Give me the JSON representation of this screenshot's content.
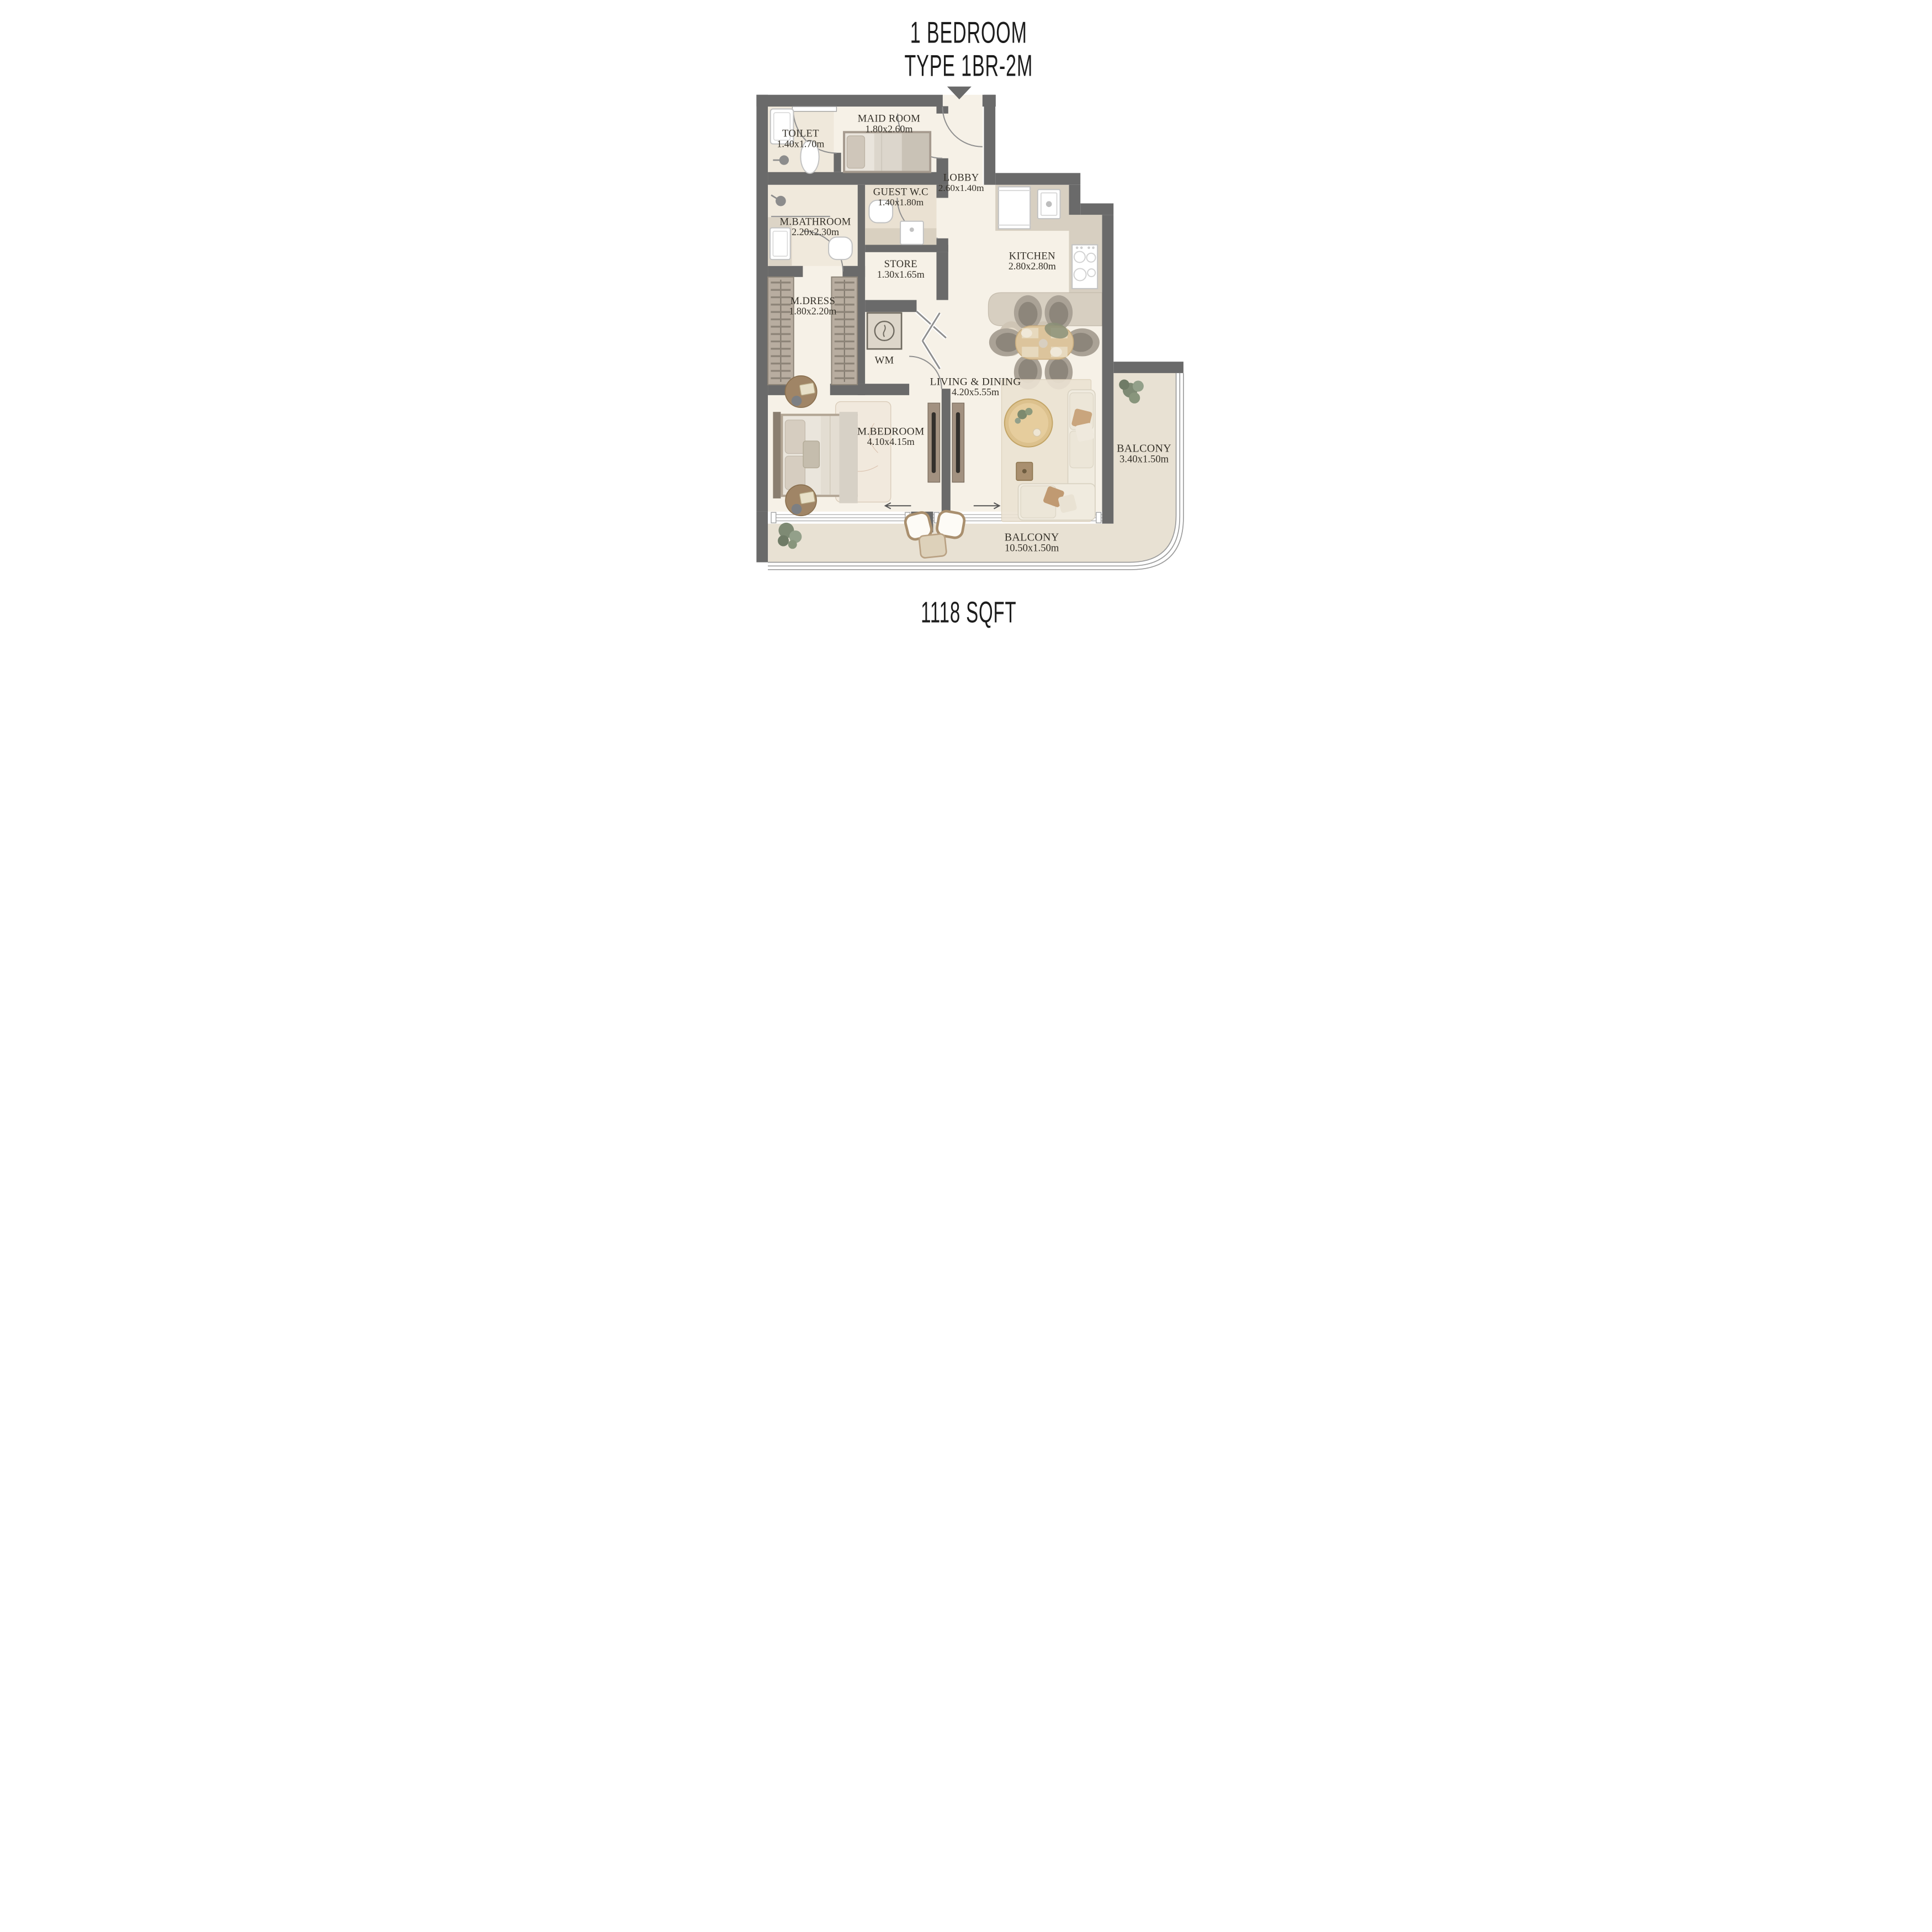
{
  "title": {
    "line1": "1 BEDROOM",
    "line2": "TYPE 1BR-2M"
  },
  "area_label": "1118 SQFT",
  "rooms": {
    "toilet": {
      "name": "TOILET",
      "dims": "1.40x1.70m"
    },
    "maid_room": {
      "name": "MAID ROOM",
      "dims": "1.80x2.60m"
    },
    "guest_wc": {
      "name": "GUEST W.C",
      "dims": "1.40x1.80m"
    },
    "lobby": {
      "name": "LOBBY",
      "dims": "2.60x1.40m"
    },
    "m_bathroom": {
      "name": "M.BATHROOM",
      "dims": "2.20x2.30m"
    },
    "store": {
      "name": "STORE",
      "dims": "1.30x1.65m"
    },
    "kitchen": {
      "name": "KITCHEN",
      "dims": "2.80x2.80m"
    },
    "m_dress": {
      "name": "M.DRESS",
      "dims": "1.80x2.20m"
    },
    "wm": {
      "name": "WM"
    },
    "m_bedroom": {
      "name": "M.BEDROOM",
      "dims": "4.10x4.15m"
    },
    "living_dining": {
      "name": "LIVING & DINING",
      "dims": "4.20x5.55m"
    },
    "balcony_right": {
      "name": "BALCONY",
      "dims": "3.40x1.50m"
    },
    "balcony_bottom": {
      "name": "BALCONY",
      "dims": "10.50x1.50m"
    }
  },
  "colors": {
    "wall": "#6a6a6a",
    "floor_main": "#f6f1e7",
    "floor_wet": "#eee7d9",
    "floor_balcony": "#e8e1d3",
    "counter_tan": "#d7cfc1",
    "wood": "#dcc18d",
    "text": "#343028"
  }
}
